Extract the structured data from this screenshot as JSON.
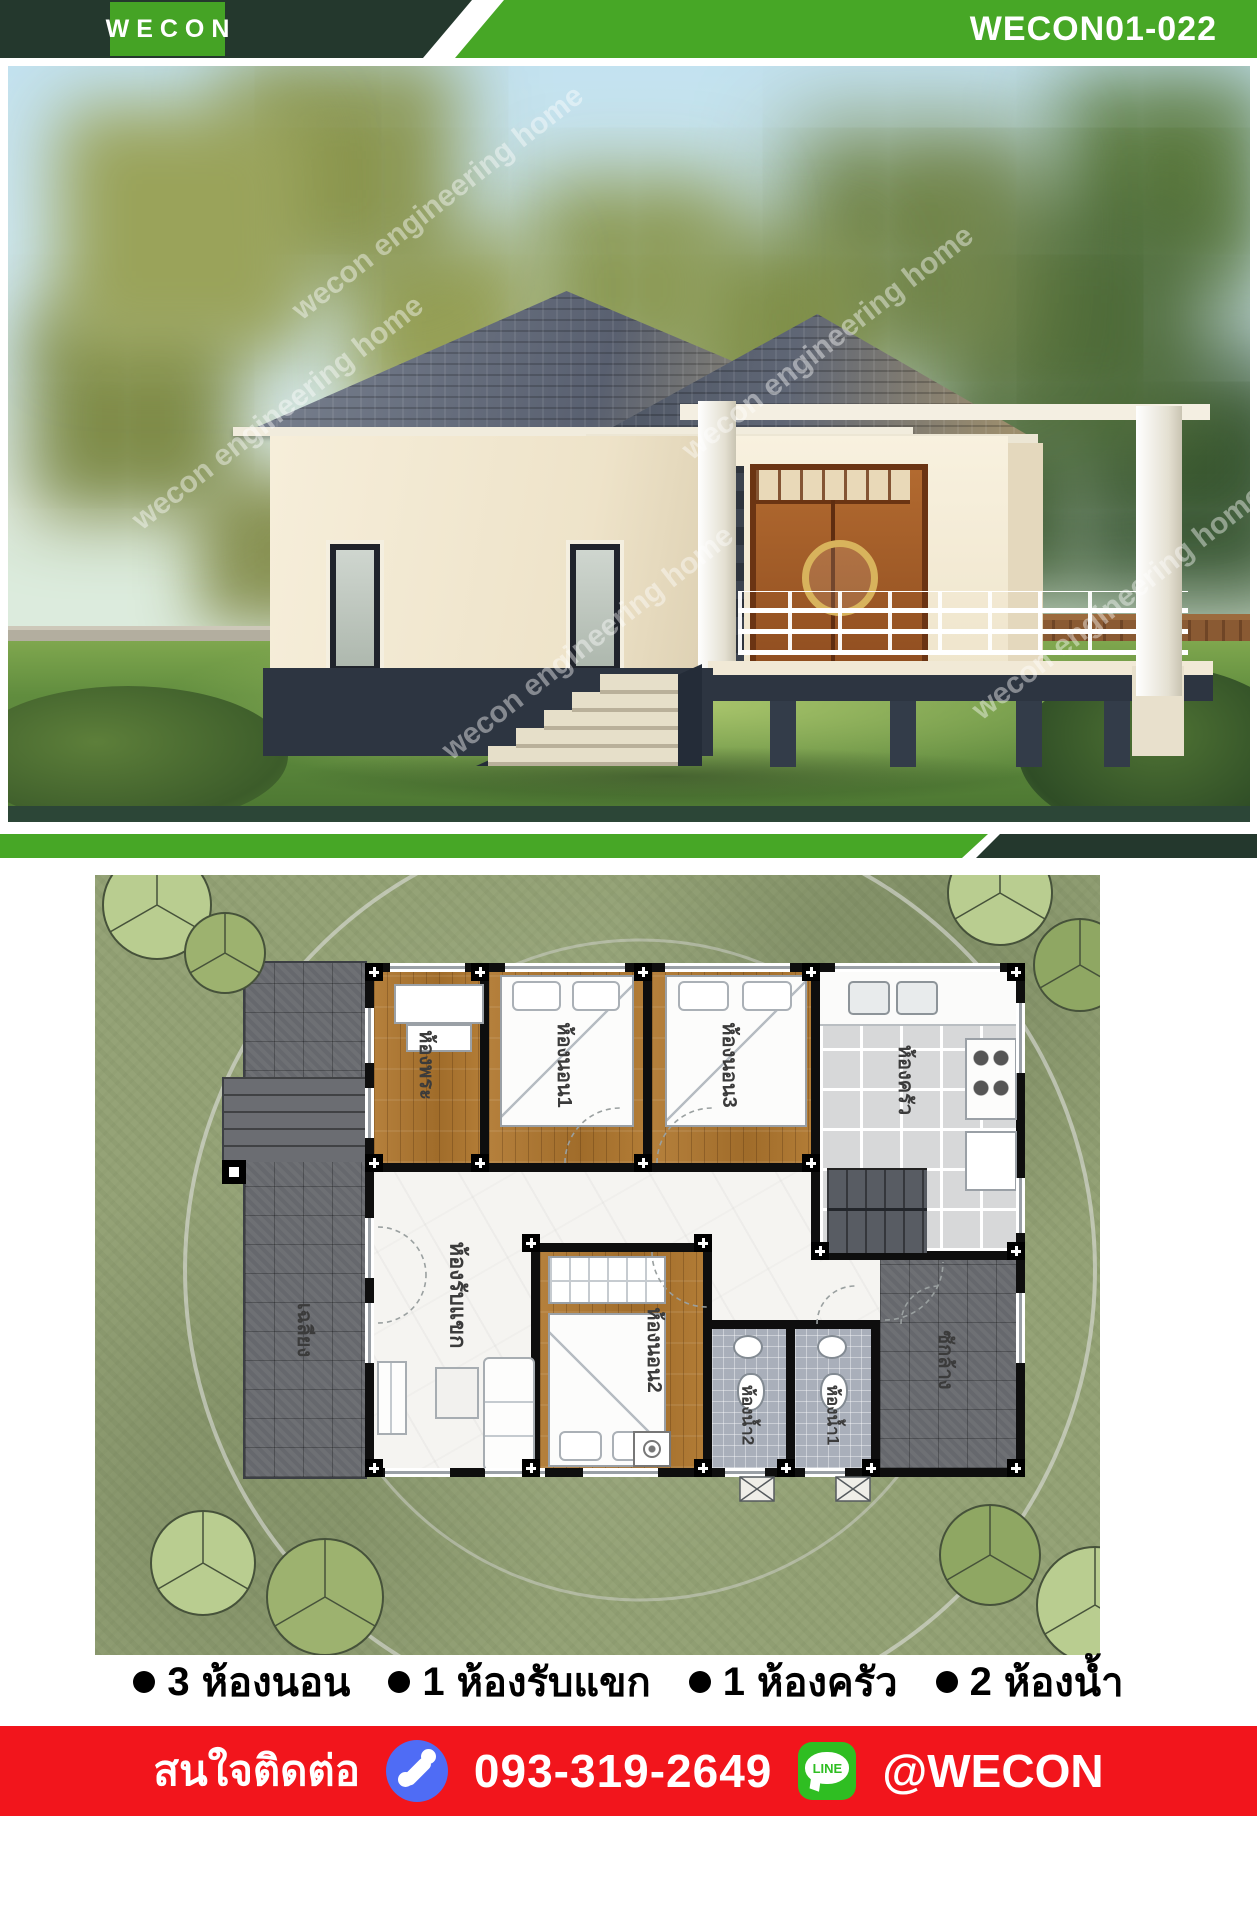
{
  "header": {
    "logo_text": "WECON",
    "code": "WECON01-022"
  },
  "photo": {
    "watermark": "wecon engineering home"
  },
  "plan": {
    "rooms": [
      {
        "id": "prayer",
        "label": "ห้องพระ"
      },
      {
        "id": "bedroom1",
        "label": "ห้องนอน1"
      },
      {
        "id": "bedroom3",
        "label": "ห้องนอน3"
      },
      {
        "id": "kitchen",
        "label": "ห้องครัว"
      },
      {
        "id": "terrace",
        "label": "เฉลียง"
      },
      {
        "id": "living",
        "label": "ห้องรับแขก"
      },
      {
        "id": "bedroom2",
        "label": "ห้องนอน2"
      },
      {
        "id": "bath2",
        "label": "ห้องน้ำ2"
      },
      {
        "id": "bath1",
        "label": "ห้องน้ำ1"
      },
      {
        "id": "laundry",
        "label": "ซักล้าง"
      }
    ]
  },
  "features": {
    "items": [
      {
        "count": "3",
        "label": "ห้องนอน"
      },
      {
        "count": "1",
        "label": "ห้องรับแขก"
      },
      {
        "count": "1",
        "label": "ห้องครัว"
      },
      {
        "count": "2",
        "label": "ห้องน้ำ"
      }
    ]
  },
  "footer": {
    "contact_label": "สนใจติดต่อ",
    "phone": "093-319-2649",
    "line_id": "@WECON",
    "line_badge": "LINE"
  },
  "icons": {
    "phone_icon": "phone-handset-in-blue-circle",
    "line_icon": "line-app-badge",
    "bullet_icon": "filled-circle"
  },
  "colors": {
    "brand_green": "#47a726",
    "dark_green": "#24382d",
    "footer_red": "#f2151c",
    "phone_blue": "#4f6cf5",
    "line_green": "#2fbe22"
  }
}
